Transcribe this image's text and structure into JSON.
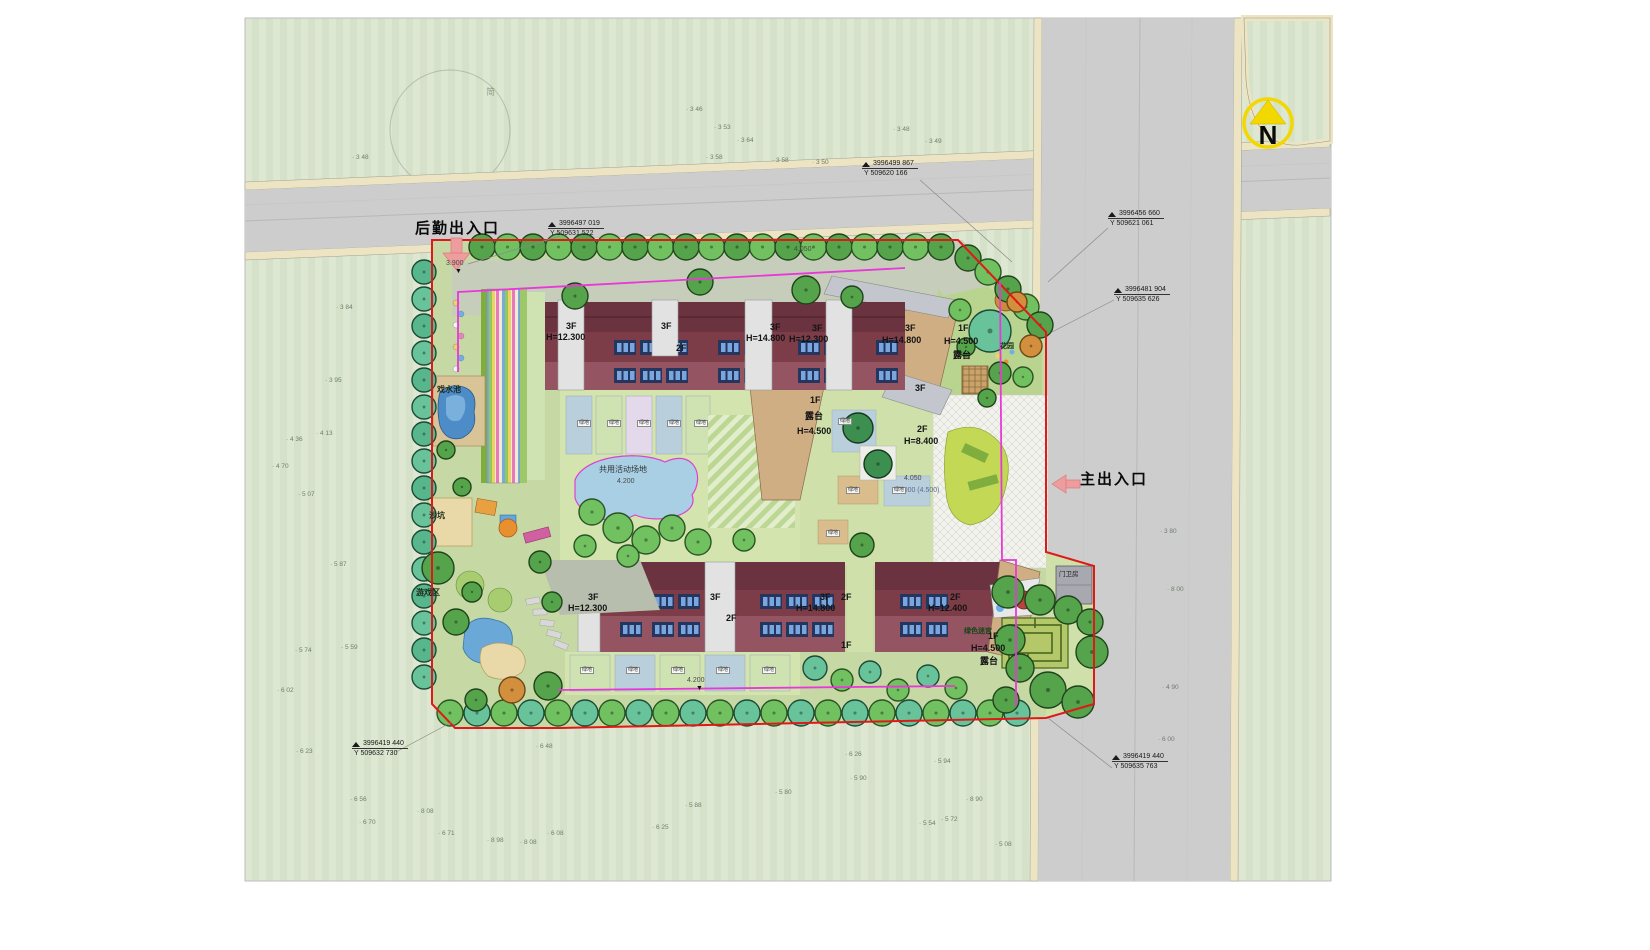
{
  "plan": {
    "entrances": {
      "rear_label": "后勤出入口",
      "main_label": "主出入口"
    },
    "compass": {
      "letter": "N"
    },
    "sketch_note": "简",
    "colors": {
      "boundary_red": "#e01818",
      "path_magenta": "#e838d8",
      "arrow_pink": "#ed9d9d",
      "compass_yellow": "#f2d800",
      "roof_maroon": "#6b3340",
      "water_blue": "#4e8cc8",
      "road_gray": "#cdcdcd",
      "sidewalk_cream": "#ece4c2"
    },
    "coordinate_callouts": [
      {
        "x": 548,
        "y": 220,
        "line1": "3996497  019",
        "line2": "Y 509631  522"
      },
      {
        "x": 862,
        "y": 160,
        "line1": "3996499  867",
        "line2": "Y 509620  166"
      },
      {
        "x": 1108,
        "y": 210,
        "line1": "3996456  660",
        "line2": "Y 509621  061"
      },
      {
        "x": 1114,
        "y": 286,
        "line1": "3996481  904",
        "line2": "Y 509635  626"
      },
      {
        "x": 352,
        "y": 740,
        "line1": "3996419  440",
        "line2": "Y 509632  730"
      },
      {
        "x": 1112,
        "y": 753,
        "line1": "3996419  440",
        "line2": "Y 509635  763"
      }
    ],
    "labels": [
      {
        "x": 566,
        "y": 322,
        "t": "3F",
        "c": "bld",
        "n": "building-label-floors"
      },
      {
        "x": 546,
        "y": 333,
        "t": "H=12.300",
        "c": "bld",
        "n": "building-label-height"
      },
      {
        "x": 661,
        "y": 322,
        "t": "3F",
        "c": "bld",
        "n": "building-label-floors"
      },
      {
        "x": 676,
        "y": 344,
        "t": "2F",
        "c": "bld",
        "n": "building-label-floors"
      },
      {
        "x": 770,
        "y": 323,
        "t": "3F",
        "c": "bld",
        "n": "building-label-floors"
      },
      {
        "x": 746,
        "y": 334,
        "t": "H=14.800",
        "c": "bld",
        "n": "building-label-height"
      },
      {
        "x": 812,
        "y": 324,
        "t": "3F",
        "c": "bld",
        "n": "building-label-floors"
      },
      {
        "x": 789,
        "y": 335,
        "t": "H=12.300",
        "c": "bld",
        "n": "building-label-height"
      },
      {
        "x": 905,
        "y": 324,
        "t": "3F",
        "c": "bld",
        "n": "building-label-floors"
      },
      {
        "x": 882,
        "y": 336,
        "t": "H=14.800",
        "c": "bld",
        "n": "building-label-height"
      },
      {
        "x": 958,
        "y": 324,
        "t": "1F",
        "c": "bld",
        "n": "building-label-floors"
      },
      {
        "x": 944,
        "y": 337,
        "t": "H=4.500",
        "c": "bld",
        "n": "building-label-height"
      },
      {
        "x": 953,
        "y": 351,
        "t": "露台",
        "c": "bld",
        "n": "terrace-label"
      },
      {
        "x": 1000,
        "y": 343,
        "t": "花园",
        "c": "garden",
        "n": "garden-label"
      },
      {
        "x": 810,
        "y": 396,
        "t": "1F",
        "c": "bld",
        "n": "building-label-floors"
      },
      {
        "x": 805,
        "y": 412,
        "t": "露台",
        "c": "bld",
        "n": "terrace-label"
      },
      {
        "x": 797,
        "y": 427,
        "t": "H=4.500",
        "c": "bld",
        "n": "building-label-height"
      },
      {
        "x": 915,
        "y": 384,
        "t": "3F",
        "c": "bld",
        "n": "building-label-floors"
      },
      {
        "x": 917,
        "y": 425,
        "t": "2F",
        "c": "bld",
        "n": "building-label-floors"
      },
      {
        "x": 904,
        "y": 437,
        "t": "H=8.400",
        "c": "bld",
        "n": "building-label-height"
      },
      {
        "x": 894,
        "y": 487,
        "t": "±0.000 (4.500)",
        "c": "lvlb",
        "n": "datum-level-label"
      },
      {
        "x": 904,
        "y": 475,
        "t": "4.050",
        "c": "lvl",
        "n": "spot-level-label"
      },
      {
        "x": 599,
        "y": 466,
        "t": "共用活动场地",
        "c": "amen2",
        "n": "shared-activity-ground-label"
      },
      {
        "x": 617,
        "y": 478,
        "t": "4.200",
        "c": "lvl",
        "n": "spot-level-label"
      },
      {
        "x": 437,
        "y": 386,
        "t": "戏水池",
        "c": "amen",
        "n": "wading-pool-label"
      },
      {
        "x": 429,
        "y": 512,
        "t": "沙坑",
        "c": "amen",
        "n": "sand-pit-label"
      },
      {
        "x": 416,
        "y": 589,
        "t": "游戏区",
        "c": "amen",
        "n": "play-area-label"
      },
      {
        "x": 964,
        "y": 628,
        "t": "绿色迷宫",
        "c": "mazeL",
        "n": "green-maze-label"
      },
      {
        "x": 1059,
        "y": 572,
        "t": "门卫房",
        "c": "guard",
        "n": "guard-house-label"
      },
      {
        "x": 588,
        "y": 593,
        "t": "3F",
        "c": "bld",
        "n": "building-label-floors"
      },
      {
        "x": 568,
        "y": 604,
        "t": "H=12.300",
        "c": "bld",
        "n": "building-label-height"
      },
      {
        "x": 710,
        "y": 593,
        "t": "3F",
        "c": "bld",
        "n": "building-label-floors"
      },
      {
        "x": 726,
        "y": 614,
        "t": "2F",
        "c": "bld",
        "n": "building-label-floors"
      },
      {
        "x": 820,
        "y": 593,
        "t": "3F",
        "c": "bld",
        "n": "building-label-floors"
      },
      {
        "x": 796,
        "y": 604,
        "t": "H=14.800",
        "c": "bld",
        "n": "building-label-height"
      },
      {
        "x": 841,
        "y": 593,
        "t": "2F",
        "c": "bld",
        "n": "building-label-floors"
      },
      {
        "x": 841,
        "y": 641,
        "t": "1F",
        "c": "bld",
        "n": "building-label-floors"
      },
      {
        "x": 950,
        "y": 593,
        "t": "2F",
        "c": "bld",
        "n": "building-label-floors"
      },
      {
        "x": 928,
        "y": 604,
        "t": "H=12.400",
        "c": "bld",
        "n": "building-label-height"
      },
      {
        "x": 988,
        "y": 632,
        "t": "1F",
        "c": "bld",
        "n": "building-label-floors"
      },
      {
        "x": 971,
        "y": 644,
        "t": "H=4.500",
        "c": "bld",
        "n": "building-label-height"
      },
      {
        "x": 980,
        "y": 657,
        "t": "露台",
        "c": "bld",
        "n": "terrace-label"
      },
      {
        "x": 446,
        "y": 260,
        "t": "3.900",
        "c": "lvl",
        "n": "spot-level-label"
      },
      {
        "x": 455,
        "y": 268,
        "t": "▼",
        "c": "tri",
        "n": "level-triangle-mark"
      },
      {
        "x": 794,
        "y": 246,
        "t": "4.050",
        "c": "lvl",
        "n": "spot-level-label"
      },
      {
        "x": 687,
        "y": 677,
        "t": "4.200",
        "c": "lvl",
        "n": "spot-level-label"
      },
      {
        "x": 696,
        "y": 685,
        "t": "▼",
        "c": "tri",
        "n": "level-triangle-mark"
      },
      {
        "x": 486,
        "y": 88,
        "t": "简",
        "c": "sketch",
        "n": "sketch-note"
      }
    ],
    "green_bed_tags": [
      {
        "x": 577,
        "y": 420,
        "t": "绿地"
      },
      {
        "x": 607,
        "y": 420,
        "t": "绿地"
      },
      {
        "x": 637,
        "y": 420,
        "t": "绿地"
      },
      {
        "x": 667,
        "y": 420,
        "t": "绿地"
      },
      {
        "x": 694,
        "y": 420,
        "t": "绿地"
      },
      {
        "x": 838,
        "y": 418,
        "t": "绿地"
      },
      {
        "x": 846,
        "y": 487,
        "t": "绿地"
      },
      {
        "x": 892,
        "y": 487,
        "t": "绿地"
      },
      {
        "x": 826,
        "y": 530,
        "t": "绿地"
      },
      {
        "x": 580,
        "y": 667,
        "t": "绿地"
      },
      {
        "x": 626,
        "y": 667,
        "t": "绿地"
      },
      {
        "x": 671,
        "y": 667,
        "t": "绿地"
      },
      {
        "x": 716,
        "y": 667,
        "t": "绿地"
      },
      {
        "x": 762,
        "y": 667,
        "t": "绿地"
      }
    ],
    "survey_points": [
      {
        "x": 352,
        "y": 155,
        "t": "3 48"
      },
      {
        "x": 686,
        "y": 107,
        "t": "3 46"
      },
      {
        "x": 714,
        "y": 125,
        "t": "3 53"
      },
      {
        "x": 737,
        "y": 138,
        "t": "3 64"
      },
      {
        "x": 893,
        "y": 127,
        "t": "3 48"
      },
      {
        "x": 925,
        "y": 139,
        "t": "3 49"
      },
      {
        "x": 706,
        "y": 155,
        "t": "3 58"
      },
      {
        "x": 772,
        "y": 158,
        "t": "3 58"
      },
      {
        "x": 812,
        "y": 160,
        "t": "3 50"
      },
      {
        "x": 336,
        "y": 305,
        "t": "3 84"
      },
      {
        "x": 325,
        "y": 378,
        "t": "3 95"
      },
      {
        "x": 286,
        "y": 437,
        "t": "4 36"
      },
      {
        "x": 316,
        "y": 431,
        "t": "4 13"
      },
      {
        "x": 272,
        "y": 464,
        "t": "4 70"
      },
      {
        "x": 298,
        "y": 492,
        "t": "5 07"
      },
      {
        "x": 330,
        "y": 562,
        "t": "5 87"
      },
      {
        "x": 341,
        "y": 645,
        "t": "5 59"
      },
      {
        "x": 295,
        "y": 648,
        "t": "5 74"
      },
      {
        "x": 277,
        "y": 688,
        "t": "6 02"
      },
      {
        "x": 296,
        "y": 749,
        "t": "6 23"
      },
      {
        "x": 350,
        "y": 797,
        "t": "6 56"
      },
      {
        "x": 359,
        "y": 820,
        "t": "6 70"
      },
      {
        "x": 438,
        "y": 831,
        "t": "6 71"
      },
      {
        "x": 417,
        "y": 809,
        "t": "8 08"
      },
      {
        "x": 487,
        "y": 838,
        "t": "8 98"
      },
      {
        "x": 520,
        "y": 840,
        "t": "8 08"
      },
      {
        "x": 547,
        "y": 831,
        "t": "6 08"
      },
      {
        "x": 536,
        "y": 744,
        "t": "6 48"
      },
      {
        "x": 652,
        "y": 825,
        "t": "6 25"
      },
      {
        "x": 685,
        "y": 803,
        "t": "5 88"
      },
      {
        "x": 775,
        "y": 790,
        "t": "5 80"
      },
      {
        "x": 845,
        "y": 752,
        "t": "6 26"
      },
      {
        "x": 850,
        "y": 776,
        "t": "5 90"
      },
      {
        "x": 934,
        "y": 759,
        "t": "5 94"
      },
      {
        "x": 966,
        "y": 797,
        "t": "8 90"
      },
      {
        "x": 919,
        "y": 821,
        "t": "5 54"
      },
      {
        "x": 941,
        "y": 817,
        "t": "5 72"
      },
      {
        "x": 995,
        "y": 842,
        "t": "5 08"
      },
      {
        "x": 1160,
        "y": 529,
        "t": "3 80"
      },
      {
        "x": 1167,
        "y": 587,
        "t": "8 00"
      },
      {
        "x": 1162,
        "y": 685,
        "t": "4 90"
      },
      {
        "x": 1158,
        "y": 737,
        "t": "6 00"
      }
    ]
  }
}
